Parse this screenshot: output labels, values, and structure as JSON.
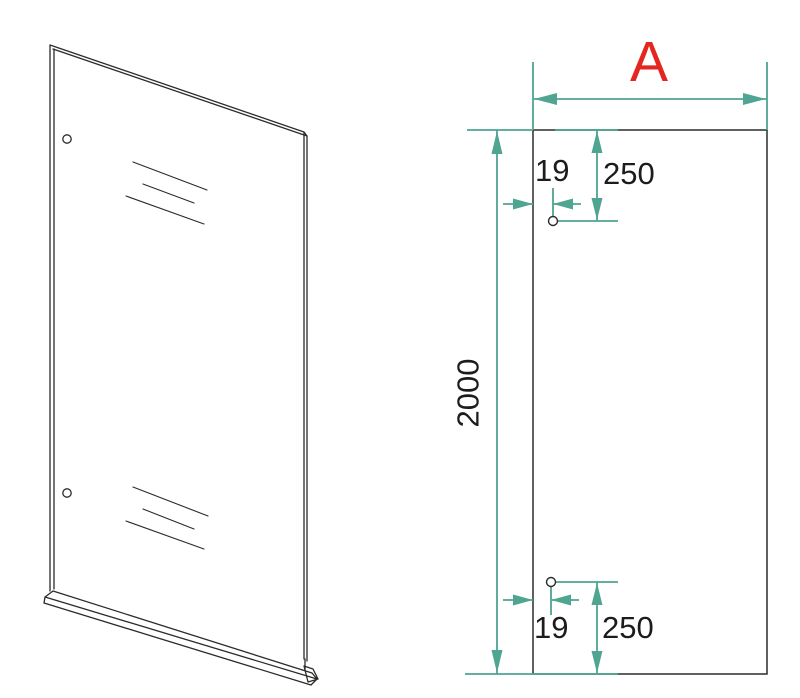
{
  "colors": {
    "outline": "#2b2b29",
    "dimension": "#4fa492",
    "text": "#1c1c1c",
    "highlight": "#e52620",
    "background": "#ffffff"
  },
  "dimensions": {
    "width": {
      "label": "A"
    },
    "height": {
      "label": "2000",
      "value": 2000,
      "unit": "mm"
    },
    "hole_offset_top": {
      "label": "19",
      "value": 19,
      "unit": "mm"
    },
    "hole_spacing_top": {
      "label": "250",
      "value": 250,
      "unit": "mm"
    },
    "hole_offset_bottom": {
      "label": "19",
      "value": 19,
      "unit": "mm"
    },
    "hole_spacing_bottom": {
      "label": "250",
      "value": 250,
      "unit": "mm"
    }
  },
  "views": {
    "isometric": {
      "holes": 2,
      "reflection_line_sets": 2
    },
    "front": {
      "holes": 2
    }
  }
}
